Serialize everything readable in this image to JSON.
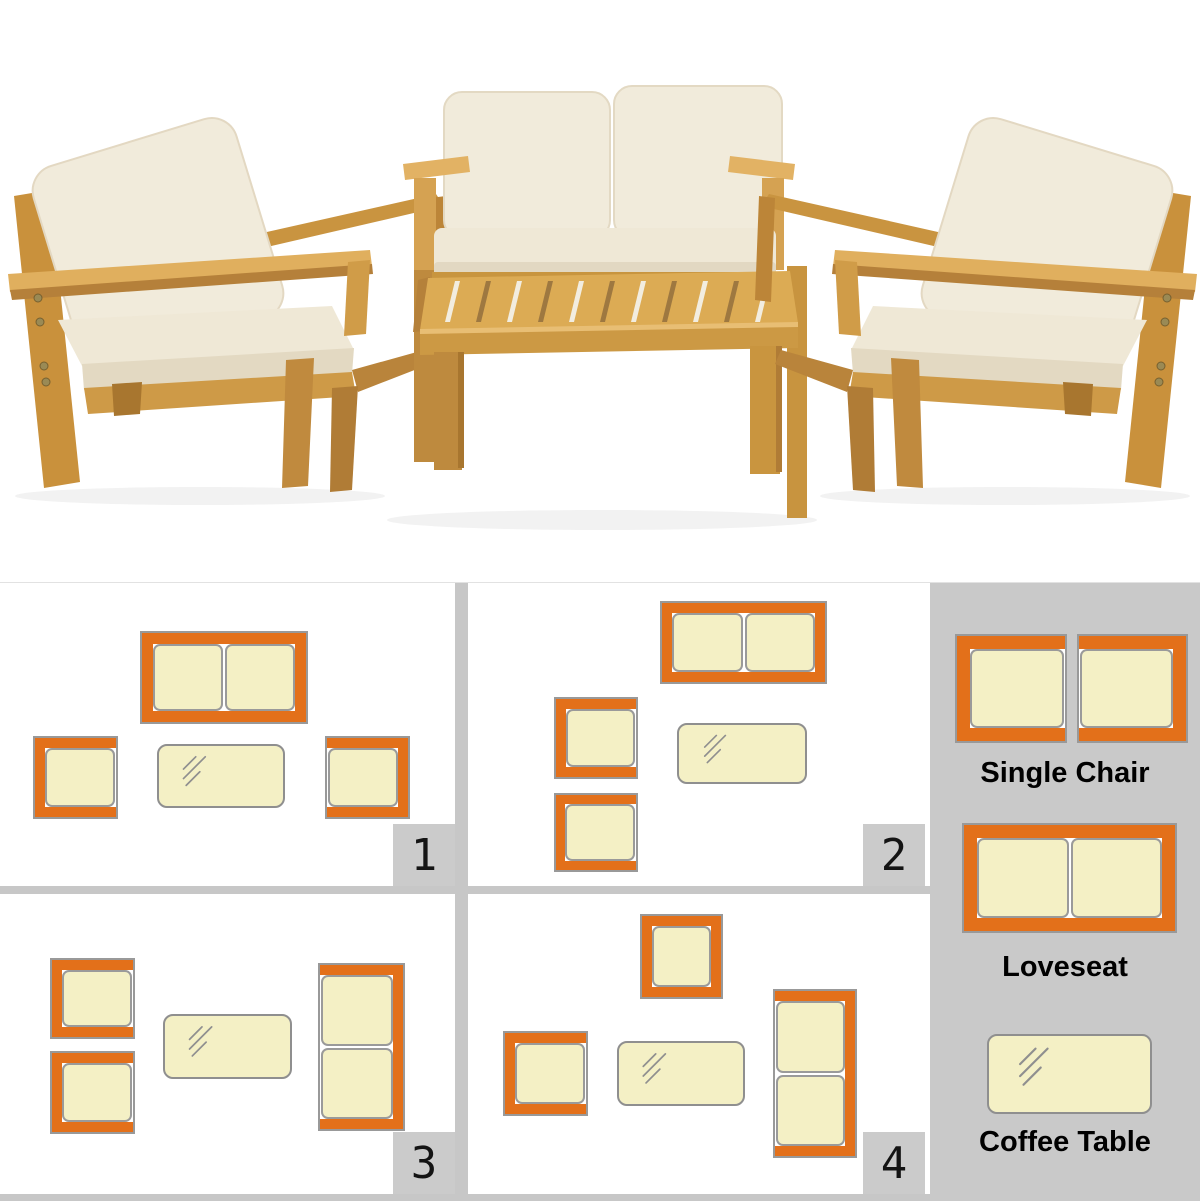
{
  "colors": {
    "accent_orange": "#E3701A",
    "symbol_fill": "#F4F0C5",
    "symbol_border": "#999999",
    "panel_background": "#FFFFFF",
    "divider_gray": "#C7C7C7",
    "legend_background": "#C9C9C9",
    "badge_background": "#CBCBCB",
    "badge_text": "#141414",
    "label_text": "#000000",
    "wood": "#D8A350",
    "cushion_cream": "#F1EBDB"
  },
  "photo": {
    "items": [
      "single chair",
      "loveseat",
      "coffee table",
      "single chair"
    ]
  },
  "panels": [
    {
      "number": "1",
      "items": [
        {
          "type": "loveseat",
          "facing": "down",
          "x": 140,
          "y": 48,
          "w": 168,
          "h": 93
        },
        {
          "type": "chair",
          "facing": "right",
          "x": 33,
          "y": 153,
          "w": 85,
          "h": 83
        },
        {
          "type": "coffee-table",
          "x": 157,
          "y": 161,
          "w": 128,
          "h": 64
        },
        {
          "type": "chair",
          "facing": "left",
          "x": 325,
          "y": 153,
          "w": 85,
          "h": 83
        }
      ]
    },
    {
      "number": "2",
      "items": [
        {
          "type": "loveseat",
          "facing": "down",
          "x": 192,
          "y": 18,
          "w": 167,
          "h": 83
        },
        {
          "type": "chair",
          "facing": "right",
          "x": 86,
          "y": 114,
          "w": 84,
          "h": 82
        },
        {
          "type": "chair",
          "facing": "right",
          "x": 86,
          "y": 210,
          "w": 84,
          "h": 79
        },
        {
          "type": "coffee-table",
          "x": 209,
          "y": 140,
          "w": 130,
          "h": 61
        }
      ]
    },
    {
      "number": "3",
      "items": [
        {
          "type": "chair",
          "facing": "right",
          "x": 50,
          "y": 64,
          "w": 85,
          "h": 81
        },
        {
          "type": "chair",
          "facing": "right",
          "x": 50,
          "y": 157,
          "w": 85,
          "h": 83
        },
        {
          "type": "coffee-table",
          "x": 163,
          "y": 120,
          "w": 129,
          "h": 65
        },
        {
          "type": "loveseat",
          "facing": "left",
          "x": 318,
          "y": 69,
          "w": 87,
          "h": 168
        }
      ]
    },
    {
      "number": "4",
      "items": [
        {
          "type": "chair",
          "facing": "down",
          "x": 172,
          "y": 20,
          "w": 83,
          "h": 85
        },
        {
          "type": "chair",
          "facing": "right",
          "x": 35,
          "y": 137,
          "w": 85,
          "h": 85
        },
        {
          "type": "coffee-table",
          "x": 149,
          "y": 147,
          "w": 128,
          "h": 65
        },
        {
          "type": "loveseat",
          "facing": "left",
          "x": 305,
          "y": 95,
          "w": 84,
          "h": 169
        }
      ]
    }
  ],
  "legend": {
    "items": [
      {
        "label": "Single Chair",
        "label_top": 174,
        "symbols": [
          {
            "type": "chair",
            "facing": "right",
            "x": 25,
            "y": 51,
            "w": 112,
            "h": 109
          },
          {
            "type": "chair",
            "facing": "left",
            "x": 147,
            "y": 51,
            "w": 111,
            "h": 109
          }
        ]
      },
      {
        "label": "Loveseat",
        "label_top": 368,
        "symbols": [
          {
            "type": "loveseat",
            "facing": "down",
            "x": 32,
            "y": 240,
            "w": 215,
            "h": 110
          }
        ]
      },
      {
        "label": "Coffee Table",
        "label_top": 543,
        "symbols": [
          {
            "type": "coffee-table",
            "x": 57,
            "y": 451,
            "w": 165,
            "h": 80
          }
        ]
      }
    ]
  }
}
